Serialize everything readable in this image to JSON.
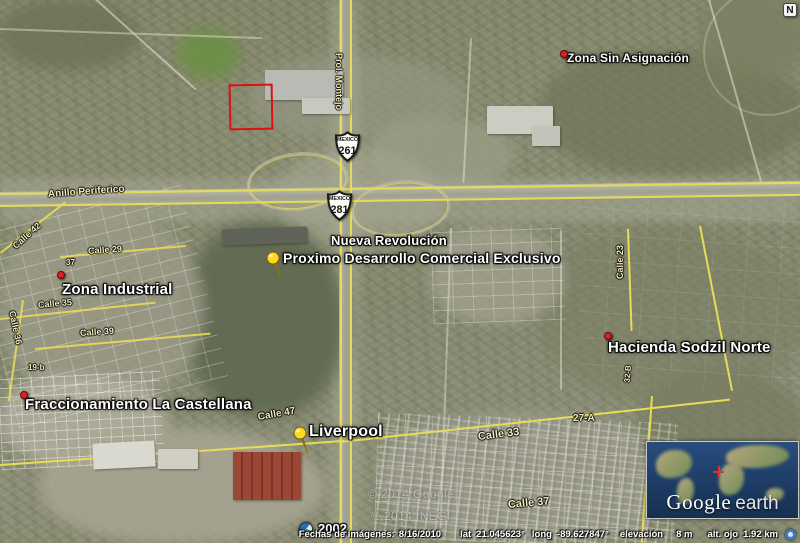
{
  "map": {
    "compass": "N",
    "timeline": {
      "year": "2002"
    },
    "copyright": [
      "© 2014 Google",
      "© 2014 INEGI"
    ],
    "status_bar": {
      "dates_label": "Fechas de imágenes:",
      "date": "8/16/2010",
      "lat_label": "lat",
      "lat": "21.045623°",
      "long_label": "long",
      "long": "-89.627847°",
      "elev_label": "elevación",
      "elev": "8 m",
      "eye_label": "alt. ojo",
      "eye": "1.92 km"
    },
    "logo": {
      "google": "Google",
      "earth": "earth"
    },
    "shields": [
      {
        "caption": "MEXICO",
        "number": "261",
        "x": 334,
        "y": 131
      },
      {
        "caption": "MEXICO",
        "number": "281",
        "x": 326,
        "y": 190
      }
    ],
    "property_outline": {
      "x": 229,
      "y": 84,
      "w": 44,
      "h": 46,
      "color": "#dd1111"
    },
    "place_labels": [
      {
        "text": "Zona Sin Asignación",
        "x": 567,
        "y": 52,
        "size": 12
      },
      {
        "text": "Nueva Revolución",
        "x": 331,
        "y": 234,
        "size": 13
      },
      {
        "text": "Proximo Desarrollo Comercial Exclusivo",
        "x": 283,
        "y": 251,
        "size": 14
      },
      {
        "text": "Zona Industrial",
        "x": 62,
        "y": 282,
        "size": 15
      },
      {
        "text": "Hacienda Sodzil Norte",
        "x": 608,
        "y": 340,
        "size": 15
      },
      {
        "text": "Fraccionamiento La Castellana",
        "x": 25,
        "y": 397,
        "size": 15
      },
      {
        "text": "Liverpool",
        "x": 309,
        "y": 423,
        "size": 16
      }
    ],
    "road_labels": [
      {
        "text": "Prol. Montejo",
        "x": 339,
        "y": 48,
        "rot": 90,
        "size": 9
      },
      {
        "text": "Anillo Periferico",
        "x": 48,
        "y": 189,
        "rot": -4,
        "size": 10
      },
      {
        "text": "Calle 42",
        "x": 14,
        "y": 242,
        "rot": -42,
        "size": 9
      },
      {
        "text": "Calle 29",
        "x": 88,
        "y": 246,
        "rot": -4,
        "size": 9
      },
      {
        "text": "37",
        "x": 66,
        "y": 258,
        "rot": 0,
        "size": 8
      },
      {
        "text": "Calle 35",
        "x": 38,
        "y": 300,
        "rot": -5,
        "size": 9
      },
      {
        "text": "Calle 36",
        "x": 12,
        "y": 306,
        "rot": 78,
        "size": 9
      },
      {
        "text": "Calle 39",
        "x": 80,
        "y": 328,
        "rot": -4,
        "size": 9
      },
      {
        "text": "19-b",
        "x": 28,
        "y": 363,
        "rot": 0,
        "size": 8
      },
      {
        "text": "Calle 23",
        "x": 620,
        "y": 274,
        "rot": -90,
        "size": 9
      },
      {
        "text": "32-B",
        "x": 627,
        "y": 378,
        "rot": -85,
        "size": 8
      },
      {
        "text": "Calle 47",
        "x": 258,
        "y": 412,
        "rot": -10,
        "size": 10
      },
      {
        "text": "27-A",
        "x": 573,
        "y": 413,
        "rot": 0,
        "size": 10
      },
      {
        "text": "Calle 33",
        "x": 478,
        "y": 431,
        "rot": -7,
        "size": 11
      },
      {
        "text": "Calle 37",
        "x": 508,
        "y": 499,
        "rot": -5,
        "size": 11
      }
    ],
    "markers": [
      {
        "type": "dot",
        "x": 560,
        "y": 50
      },
      {
        "type": "dot",
        "x": 57,
        "y": 271
      },
      {
        "type": "dot",
        "x": 604,
        "y": 332
      },
      {
        "type": "dot",
        "x": 20,
        "y": 391
      },
      {
        "type": "pin",
        "x": 264,
        "y": 250
      },
      {
        "type": "pin",
        "x": 291,
        "y": 425
      }
    ],
    "colors": {
      "road_overlay_yellow": "#e8dc55",
      "road_label_yellow": "#f2ecc0",
      "annotation_red": "#dd1111"
    }
  }
}
